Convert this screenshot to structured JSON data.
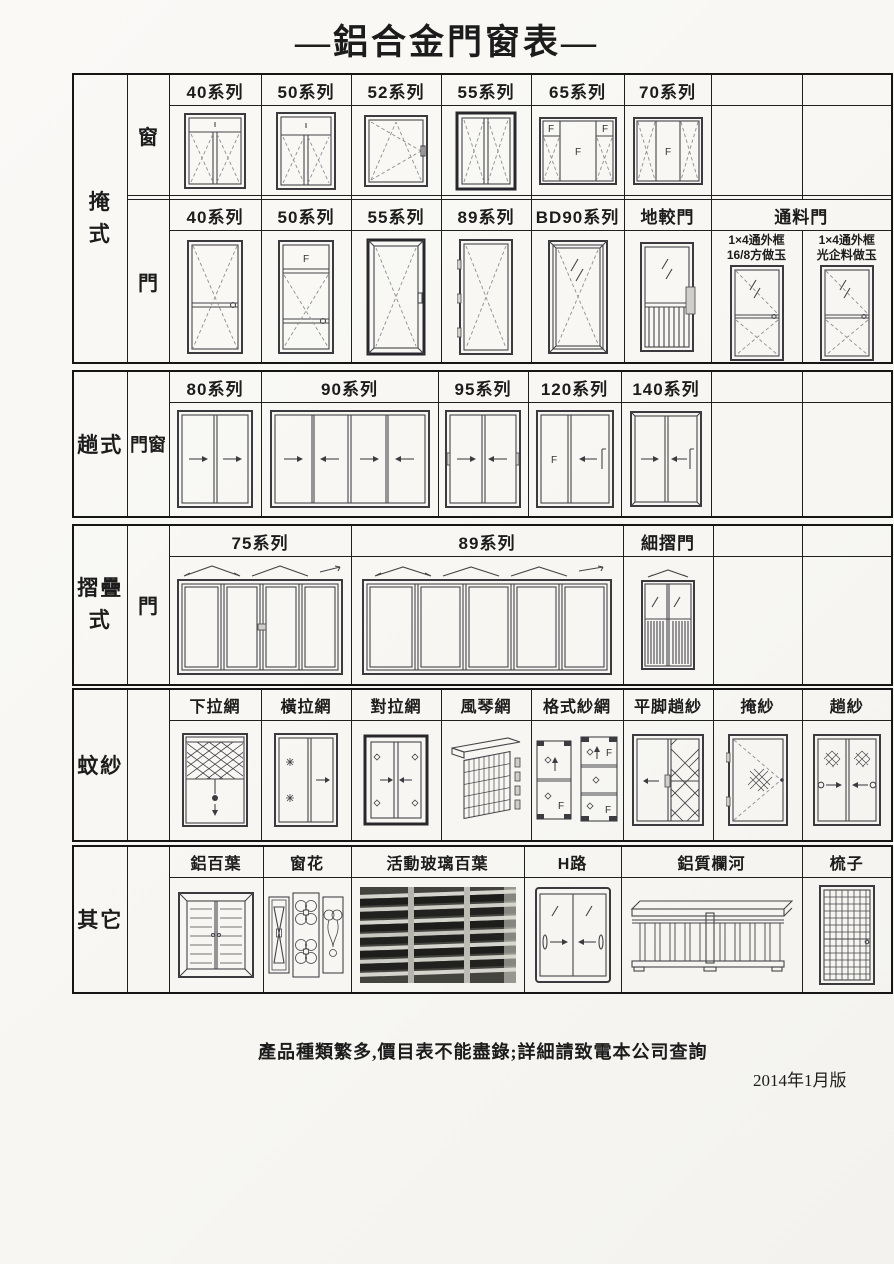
{
  "page": {
    "title": "—鋁合金門窗表—",
    "note": "產品種類繁多,價目表不能盡錄;詳細請致電本公司查詢",
    "version": "2014年1月版"
  },
  "glyphs": {
    "f": "F"
  },
  "hinged": {
    "category": "掩式",
    "window_label": "窗",
    "window_headers": [
      "40系列",
      "50系列",
      "52系列",
      "55系列",
      "65系列",
      "70系列",
      "",
      ""
    ],
    "door_label": "門",
    "door_headers": [
      "40系列",
      "50系列",
      "55系列",
      "89系列",
      "BD90系列",
      "地較門",
      "通料門"
    ],
    "pass_door_variants": [
      {
        "line1": "1×4通外框",
        "line2": "16/8方做玉"
      },
      {
        "line1": "1×4通外框",
        "line2": "光企料做玉"
      }
    ]
  },
  "sliding": {
    "category": "趟式",
    "row_label": "門窗",
    "headers": [
      "80系列",
      "90系列",
      "95系列",
      "120系列",
      "140系列",
      "",
      ""
    ]
  },
  "folding": {
    "category": "摺疊式",
    "row_label": "門",
    "headers": [
      "75系列",
      "89系列",
      "細摺門",
      "",
      ""
    ]
  },
  "screens": {
    "category": "蚊紗",
    "headers": [
      "下拉網",
      "橫拉網",
      "對拉網",
      "風琴網",
      "格式紗網",
      "平脚趟紗",
      "掩紗",
      "趟紗"
    ]
  },
  "others": {
    "category": "其它",
    "headers": [
      "鋁百葉",
      "窗花",
      "活動玻璃百葉",
      "H路",
      "鋁質欄河",
      "梳子"
    ]
  }
}
